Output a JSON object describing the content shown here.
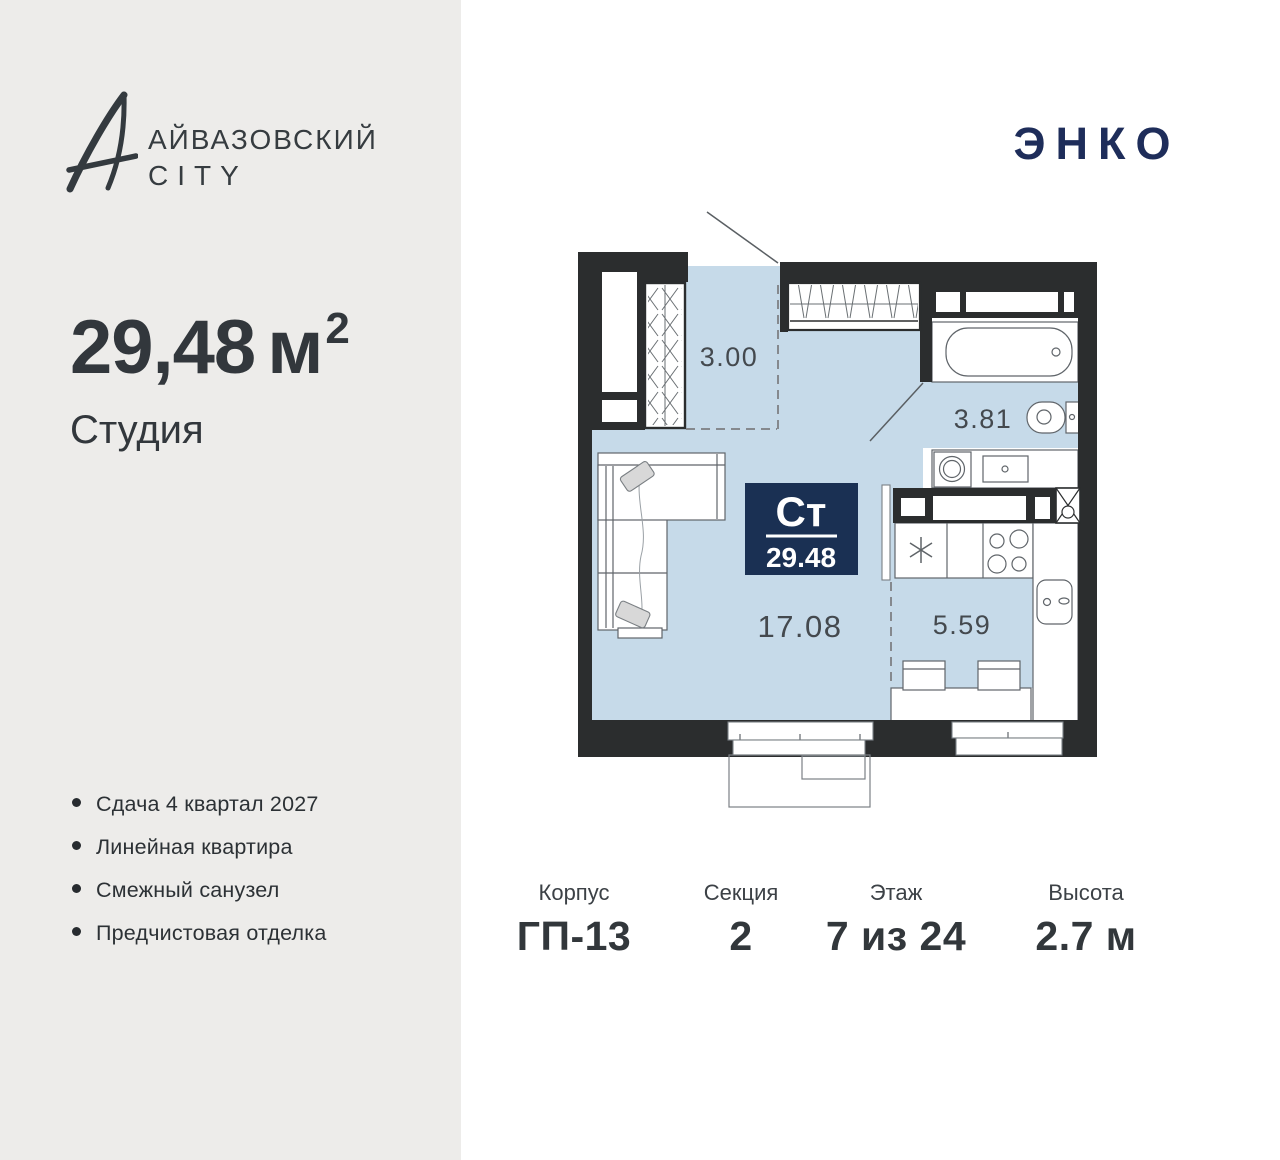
{
  "brand": {
    "icon": "ayvazovsky-a-monogram",
    "line1": "АЙВАЗОВСКИЙ",
    "line2": "CITY"
  },
  "developer": {
    "logo_text": "ЭНКО"
  },
  "apartment": {
    "area_value": "29,48",
    "area_unit": "м",
    "area_exp": "2",
    "type_label": "Студия"
  },
  "features": [
    "Сдача 4 квартал 2027",
    "Линейная квартира",
    "Смежный санузел",
    "Предчистовая отделка"
  ],
  "plan": {
    "badge": {
      "type_abbr": "Ст",
      "area": "29.48"
    },
    "rooms": {
      "loggia": "3.00",
      "bathroom": "3.81",
      "living": "17.08",
      "kitchen": "5.59"
    }
  },
  "details": [
    {
      "label": "Корпус",
      "value": "ГП-13"
    },
    {
      "label": "Секция",
      "value": "2"
    },
    {
      "label": "Этаж",
      "value": "7 из 24"
    },
    {
      "label": "Высота",
      "value": "2.7 м"
    }
  ],
  "colors": {
    "panel_bg": "#edecea",
    "room_fill": "#c6dae9",
    "wall": "#2b2d2e",
    "accent_navy": "#1a3053",
    "developer_navy": "#1e2d5a",
    "text_dark": "#32373c"
  }
}
